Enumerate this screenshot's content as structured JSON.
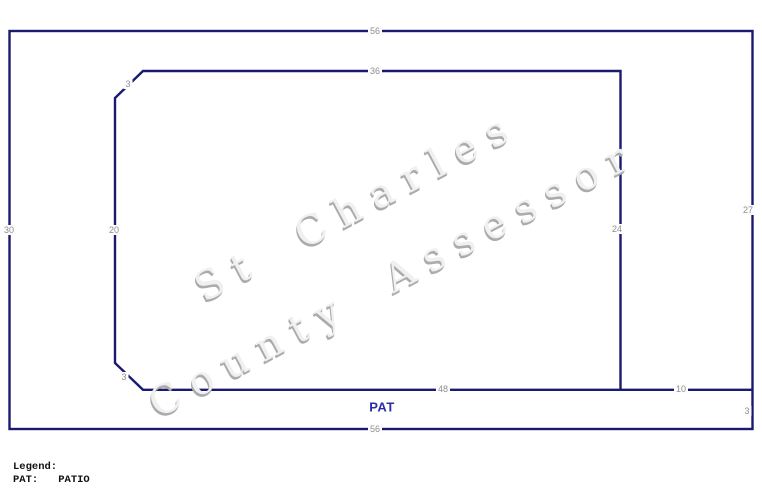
{
  "watermark": {
    "line1": "St Charles",
    "line2": "County Assessor"
  },
  "sketch": {
    "area_code": "PAT",
    "dimensions": {
      "outer_top": "56",
      "outer_bottom": "56",
      "outer_left": "30",
      "outer_right_upper": "27",
      "outer_right_lower": "3",
      "inner_top": "36",
      "inner_left": "20",
      "inner_right": "24",
      "inner_bottom": "48",
      "inner_bottom_right": "10",
      "chamfer_top_left": "3",
      "chamfer_bottom_left": "3"
    }
  },
  "legend": {
    "title": "Legend:",
    "entries": [
      {
        "code": "PAT:",
        "label": "PATIO"
      }
    ]
  },
  "colors": {
    "line": "#1a1a70",
    "dimension_label": "#8f8f8f",
    "area_label": "#2d2daa",
    "watermark": "#c9c9c9",
    "background": "#ffffff"
  }
}
